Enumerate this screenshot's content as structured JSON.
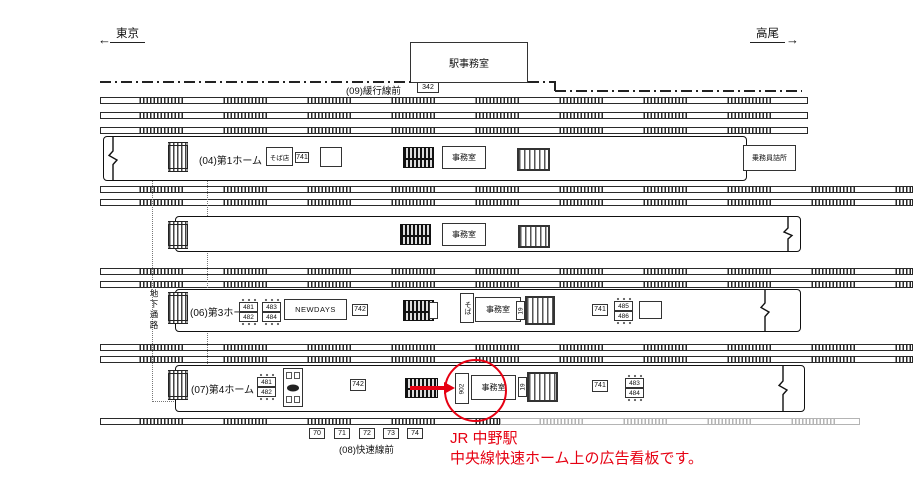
{
  "direction_arrows": {
    "left": "東京",
    "right": "高尾"
  },
  "header": {
    "station_office": "駅事務室",
    "office_tag": "342",
    "slow_line_row_label": "(09)緩行線前"
  },
  "common": {
    "office": "事務室",
    "tag741": "741",
    "tag742": "742"
  },
  "platform1": {
    "name": "(04)第1ホーム",
    "soba_shop": "そば店",
    "crew_office": "乗務員詰所"
  },
  "platform2": {},
  "platform3": {
    "name": "(06)第3ホーム",
    "bench_a": [
      "481",
      "482"
    ],
    "bench_b": [
      "483",
      "484"
    ],
    "bench_c": [
      "485",
      "486"
    ],
    "kiosk": "NEWDAYS",
    "soba_stand": "そば",
    "stair_tag": "19"
  },
  "platform4": {
    "name": "(07)第4ホーム",
    "bench_a": [
      "481",
      "482"
    ],
    "bench_b": [
      "483",
      "484"
    ],
    "highlight_tag": "902",
    "stair_tag": "19"
  },
  "passage": {
    "label": "地下通路"
  },
  "footer": {
    "tags": [
      "70",
      "71",
      "72",
      "73",
      "74"
    ],
    "rapid_line_row_label": "(08)快速線前"
  },
  "annotation": {
    "line1": "JR 中野駅",
    "line2": "中央線快速ホーム上の広告看板です。",
    "accent_color": "#e60012"
  },
  "colors": {
    "ink": "#1a1a1a",
    "accent": "#e60012",
    "gray_track": "#b4b4b4"
  }
}
